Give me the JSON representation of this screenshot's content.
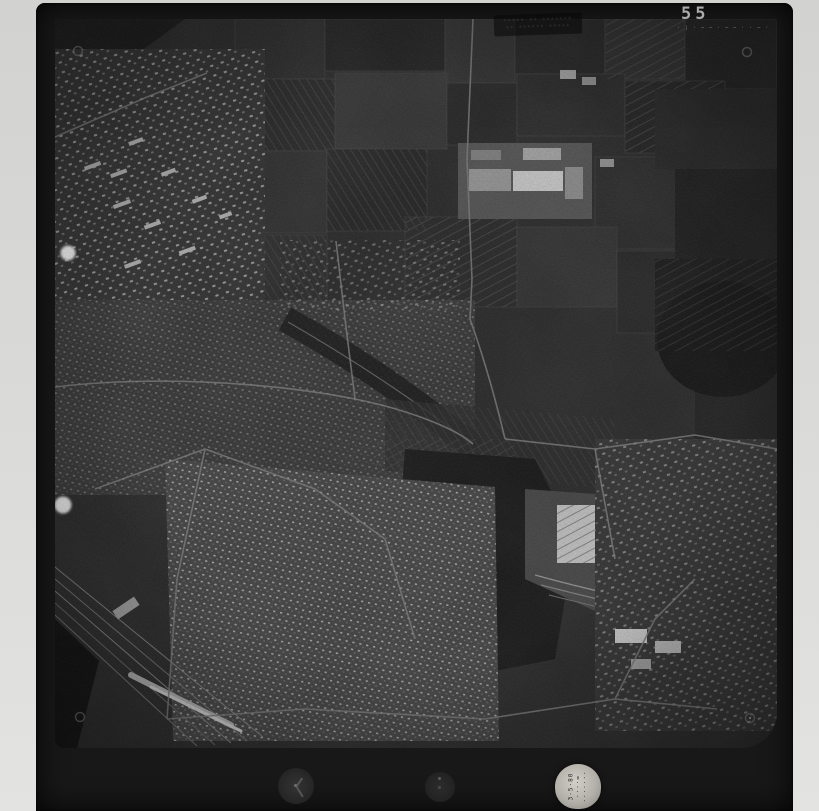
{
  "frame": {
    "number": "55",
    "edge_marks": "· ¦ · – – · – – · · – ·"
  },
  "stamp": {
    "line1": "····· ·· ·······",
    "line2": "·· ······ ·····"
  },
  "data_plate": {
    "line1": "3·5·80",
    "line2": "····=",
    "line3": "·······"
  },
  "colors": {
    "scanner_background": "#d9d9d7",
    "film_black": "#181818",
    "photo_base": "#2e2e2e",
    "highlight_gray": "#b8b8b8",
    "frame_number_gray": "#ababab"
  },
  "marks": {
    "fiducial_rings": [
      "top-left",
      "top-right",
      "bottom-left",
      "bottom-right"
    ],
    "blemishes": 2,
    "instruments": [
      "clock-dial",
      "altimeter-dial",
      "data-plate"
    ]
  }
}
